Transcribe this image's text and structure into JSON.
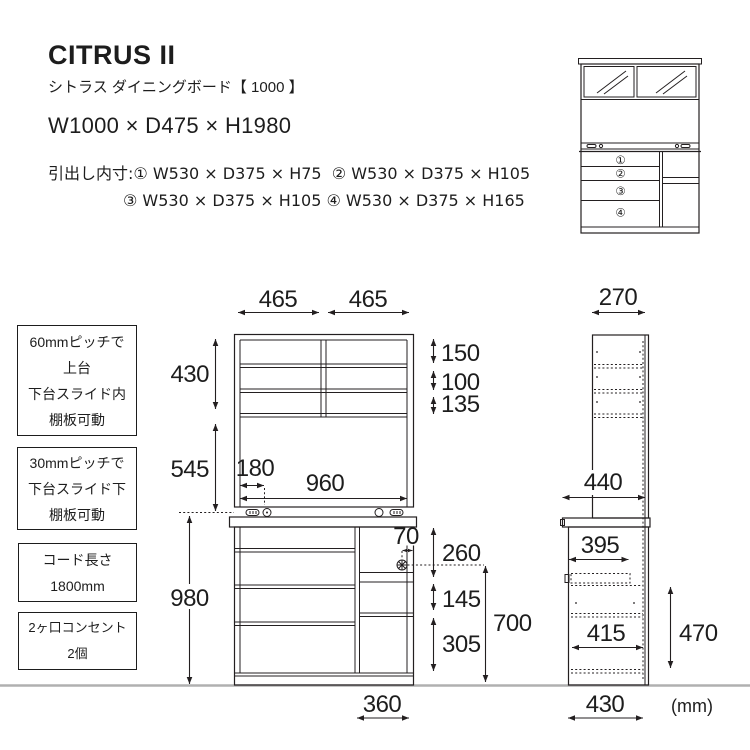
{
  "header": {
    "title": "CITRUS II",
    "subtitle": "シトラス ダイニングボード【 1000 】",
    "overall_size": "W1000 × D475 × H1980",
    "drawer_specs_label": "引出し内寸:",
    "drawer_specs_line1_rest": "① W530 × D375 × H75  ② W530 × D375 × H105",
    "drawer_specs_line2": "③ W530 × D375 × H105 ④ W530 × D375 × H165"
  },
  "notes": [
    {
      "lines": [
        "60mmピッチで",
        "上台",
        "下台スライド内",
        "棚板可動"
      ]
    },
    {
      "lines": [
        "30mmピッチで",
        "下台スライド下",
        "棚板可動"
      ]
    },
    {
      "lines": [
        "コード長さ",
        "1800mm"
      ]
    },
    {
      "lines": [
        "2ヶ口コンセント",
        "2個"
      ]
    }
  ],
  "front_view": {
    "top_width_left": "465",
    "top_width_right": "465",
    "upper_height": "430",
    "middle_height": "545",
    "lower_height": "980",
    "shelf_gap_top": "150",
    "shelf_gap_middle": "100",
    "shelf_gap_bottom": "135",
    "outlet_offset": "180",
    "inner_width": "960",
    "hook_offset": "70",
    "counter_to_hook": "260",
    "niche_height": "145",
    "lower_door_height": "305",
    "hook_to_floor": "700",
    "right_section_width": "360"
  },
  "side_view": {
    "upper_depth": "270",
    "counter_depth": "440",
    "upper_inner_depth": "395",
    "lower_inner_depth": "415",
    "lower_height": "470",
    "floor_depth": "430"
  },
  "thumbnail": {
    "drawer_numbers": [
      "①",
      "②",
      "③",
      "④"
    ]
  },
  "unit_label": "(mm)"
}
